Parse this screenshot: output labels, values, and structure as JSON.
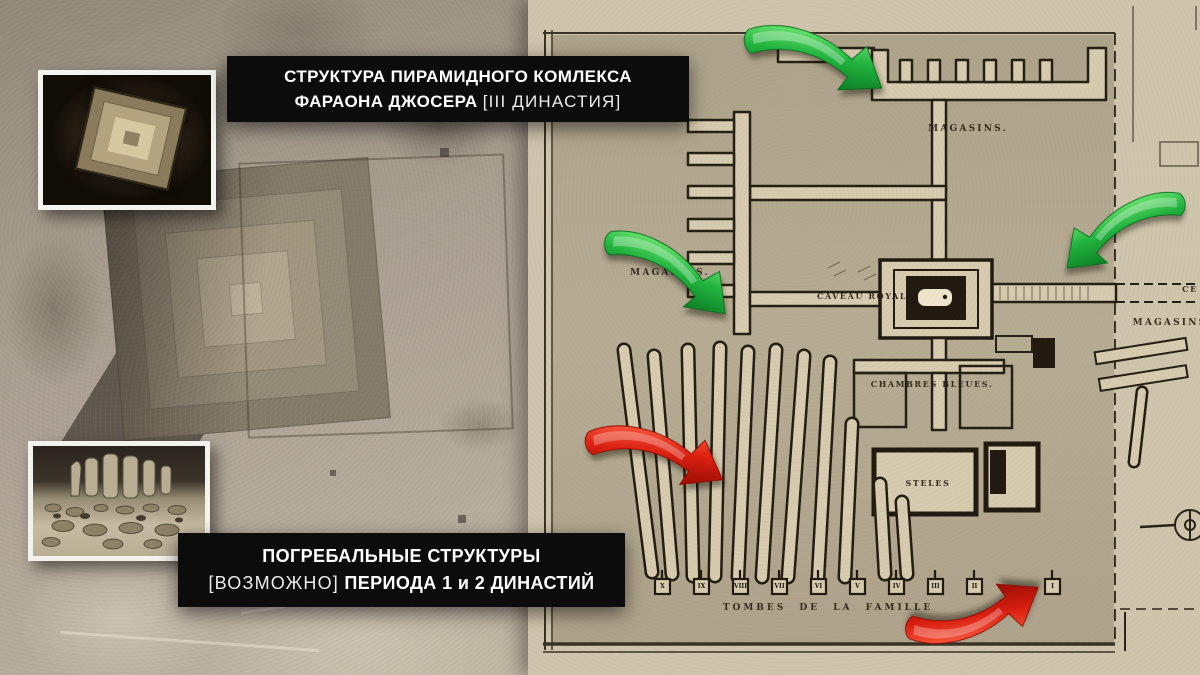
{
  "banners": {
    "top": {
      "line1": "СТРУКТУРА ПИРАМИДНОГО КОМЛЕКСА",
      "line2_bold": "ФАРАОНА ДЖОСЕРА",
      "line2_light": "[III ДИНАСТИЯ]"
    },
    "bottom": {
      "line1": "ПОГРЕБАЛЬНЫЕ СТРУКТУРЫ",
      "line2_light": "[ВОЗМОЖНО]",
      "line2_bold": "ПЕРИОДА 1 и 2 ДИНАСТИЙ"
    }
  },
  "map": {
    "labels": {
      "magasins_top": "MAGASINS.",
      "magasins_left": "MAGASINS.",
      "magasins_right": "MAGASINS",
      "caveau_royal": "CAVEAU ROYAL",
      "chambres_bleues": "CHAMBRES BLEUES.",
      "steles": "STELES",
      "tombes": "TOMBES DE LA FAMILLE",
      "edge_partial": "CE"
    },
    "tomb_numerals": [
      "X",
      "IX",
      "VIII",
      "VII",
      "VI",
      "V",
      "IV",
      "III",
      "II",
      "I"
    ]
  },
  "colors": {
    "arrow_green": "#1fae3c",
    "arrow_red": "#d41f10",
    "banner_bg": "#0c0c0c",
    "banner_text": "#ffffff",
    "paper": "#cfc4ac",
    "paper_dark": "#b4a991",
    "ink": "#2a2217"
  }
}
